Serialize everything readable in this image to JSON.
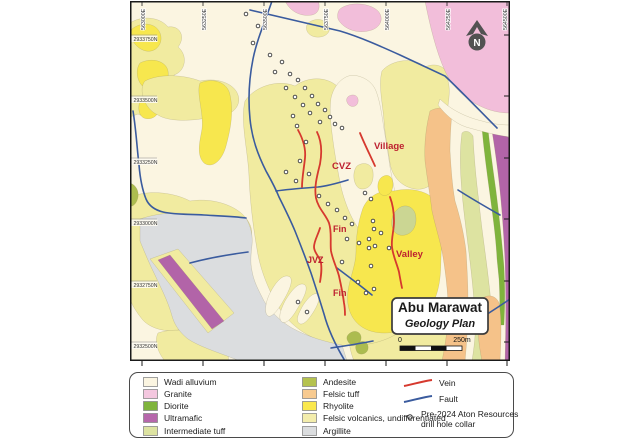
{
  "map": {
    "title": "Abu Marawat",
    "subtitle": "Geology Plan",
    "scale_bar": {
      "start": "0",
      "end": "250m"
    },
    "grid": {
      "eastings": [
        "563000E",
        "563250E",
        "563500E",
        "563750E",
        "564000E",
        "564250E",
        "564500E"
      ],
      "northings": [
        "2933750N",
        "2933500N",
        "2933250N",
        "2933000N",
        "2932750N",
        "2932500N"
      ]
    },
    "prospect_labels": [
      "Village",
      "CVZ",
      "Fin",
      "JVZ",
      "Fin",
      "Valley"
    ],
    "label_color": "#BD2130",
    "north_letter": "N",
    "drill_collars": [
      [
        116,
        13
      ],
      [
        128,
        25
      ],
      [
        123,
        42
      ],
      [
        140,
        54
      ],
      [
        152,
        61
      ],
      [
        145,
        71
      ],
      [
        160,
        73
      ],
      [
        168,
        79
      ],
      [
        156,
        87
      ],
      [
        175,
        87
      ],
      [
        165,
        96
      ],
      [
        182,
        95
      ],
      [
        173,
        104
      ],
      [
        188,
        103
      ],
      [
        195,
        109
      ],
      [
        180,
        112
      ],
      [
        200,
        116
      ],
      [
        190,
        121
      ],
      [
        205,
        123
      ],
      [
        212,
        127
      ],
      [
        163,
        115
      ],
      [
        167,
        125
      ],
      [
        176,
        141
      ],
      [
        170,
        160
      ],
      [
        179,
        173
      ],
      [
        156,
        171
      ],
      [
        189,
        195
      ],
      [
        198,
        203
      ],
      [
        166,
        180
      ],
      [
        207,
        209
      ],
      [
        215,
        217
      ],
      [
        222,
        223
      ],
      [
        235,
        192
      ],
      [
        241,
        198
      ],
      [
        243,
        220
      ],
      [
        244,
        228
      ],
      [
        251,
        232
      ],
      [
        239,
        247
      ],
      [
        259,
        247
      ],
      [
        241,
        265
      ],
      [
        244,
        288
      ],
      [
        236,
        292
      ],
      [
        217,
        238
      ],
      [
        229,
        242
      ],
      [
        239,
        238
      ],
      [
        245,
        245
      ],
      [
        212,
        261
      ],
      [
        228,
        281
      ],
      [
        168,
        301
      ],
      [
        177,
        311
      ]
    ]
  },
  "legend": {
    "units": [
      {
        "label": "Wadi alluvium",
        "color": "#FBF5E1"
      },
      {
        "label": "Granite",
        "color": "#F4C7DF"
      },
      {
        "label": "Diorite",
        "color": "#7FB43C"
      },
      {
        "label": "Ultramafic",
        "color": "#B667AB"
      },
      {
        "label": "Intermediate tuff",
        "color": "#DDE3A1"
      },
      {
        "label": "Andesite",
        "color": "#B5C24F"
      },
      {
        "label": "Felsic tuff",
        "color": "#F7CA90"
      },
      {
        "label": "Rhyolite",
        "color": "#FAE84D"
      },
      {
        "label": "Felsic volcanics, undifferentiated",
        "color": "#F3EDAC"
      },
      {
        "label": "Argillite",
        "color": "#DBDDDF"
      }
    ],
    "symbols": {
      "vein_label": "Vein",
      "vein_color": "#D6392E",
      "fault_label": "Fault",
      "fault_color": "#3A5B9E",
      "collar_label_line1": "Pre-2024 Aton Resources",
      "collar_label_line2": "drill hole collar"
    }
  }
}
